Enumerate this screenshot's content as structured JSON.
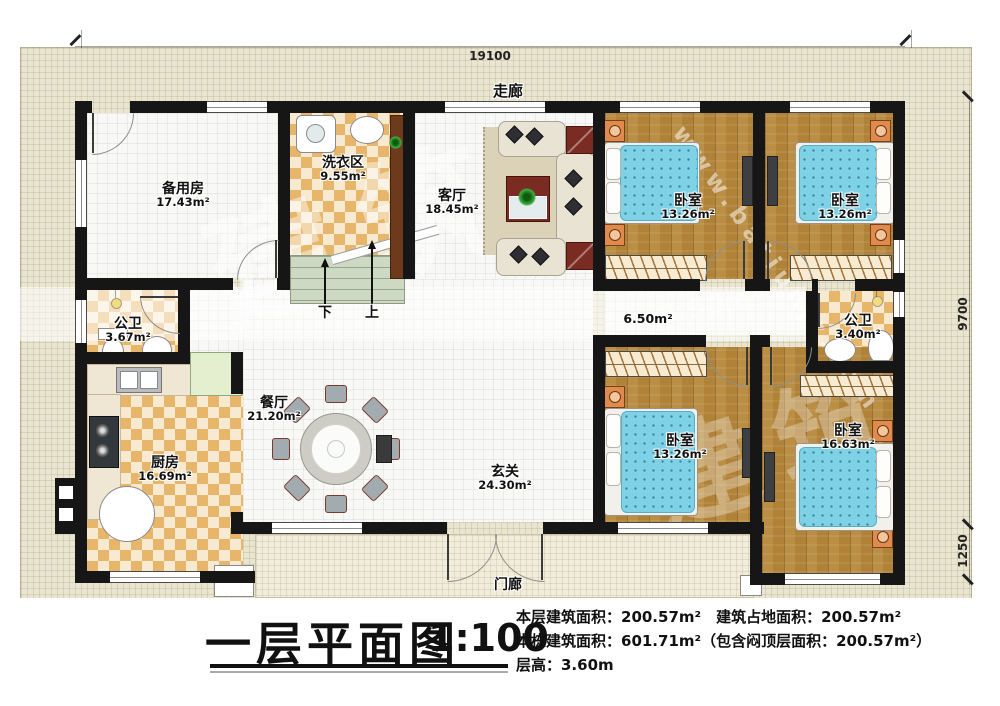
{
  "site": {
    "corridor_label": "走廊",
    "porch_label": "门廊"
  },
  "dimensions": {
    "top": "19100",
    "right_upper": "9700",
    "right_lower": "1250"
  },
  "stairs": {
    "down": "下",
    "up": "上"
  },
  "areas": {
    "corridor_mid": "6.50m²"
  },
  "rooms": {
    "spare": {
      "name": "备用房",
      "area": "17.43m²"
    },
    "laundry": {
      "name": "洗衣区",
      "area": "9.55m²"
    },
    "living": {
      "name": "客厅",
      "area": "18.45m²"
    },
    "bedroom_tl": {
      "name": "卧室",
      "area": "13.26m²"
    },
    "bedroom_tr": {
      "name": "卧室",
      "area": "13.26m²"
    },
    "bath_left": {
      "name": "公卫",
      "area": "3.67m²"
    },
    "bath_right": {
      "name": "公卫",
      "area": "3.40m²"
    },
    "kitchen": {
      "name": "厨房",
      "area": "16.69m²"
    },
    "dining": {
      "name": "餐厅",
      "area": "21.20m²"
    },
    "foyer": {
      "name": "玄关",
      "area": "24.30m²"
    },
    "bedroom_bm": {
      "name": "卧室",
      "area": "13.26m²"
    },
    "bedroom_br": {
      "name": "卧室",
      "area": "16.63m²"
    }
  },
  "title_block": {
    "title": "一层平面图",
    "scale": "1:100",
    "info_line1": "本层建筑面积：200.57m²　建筑占地面积：200.57m²",
    "info_line2": "本栋建筑面积：601.71m²（包含闷顶层面积：200.57m²）",
    "info_line3": "层高：3.60m"
  },
  "watermark": {
    "url": "www.batiunjz.com",
    "chars": "建筑"
  }
}
